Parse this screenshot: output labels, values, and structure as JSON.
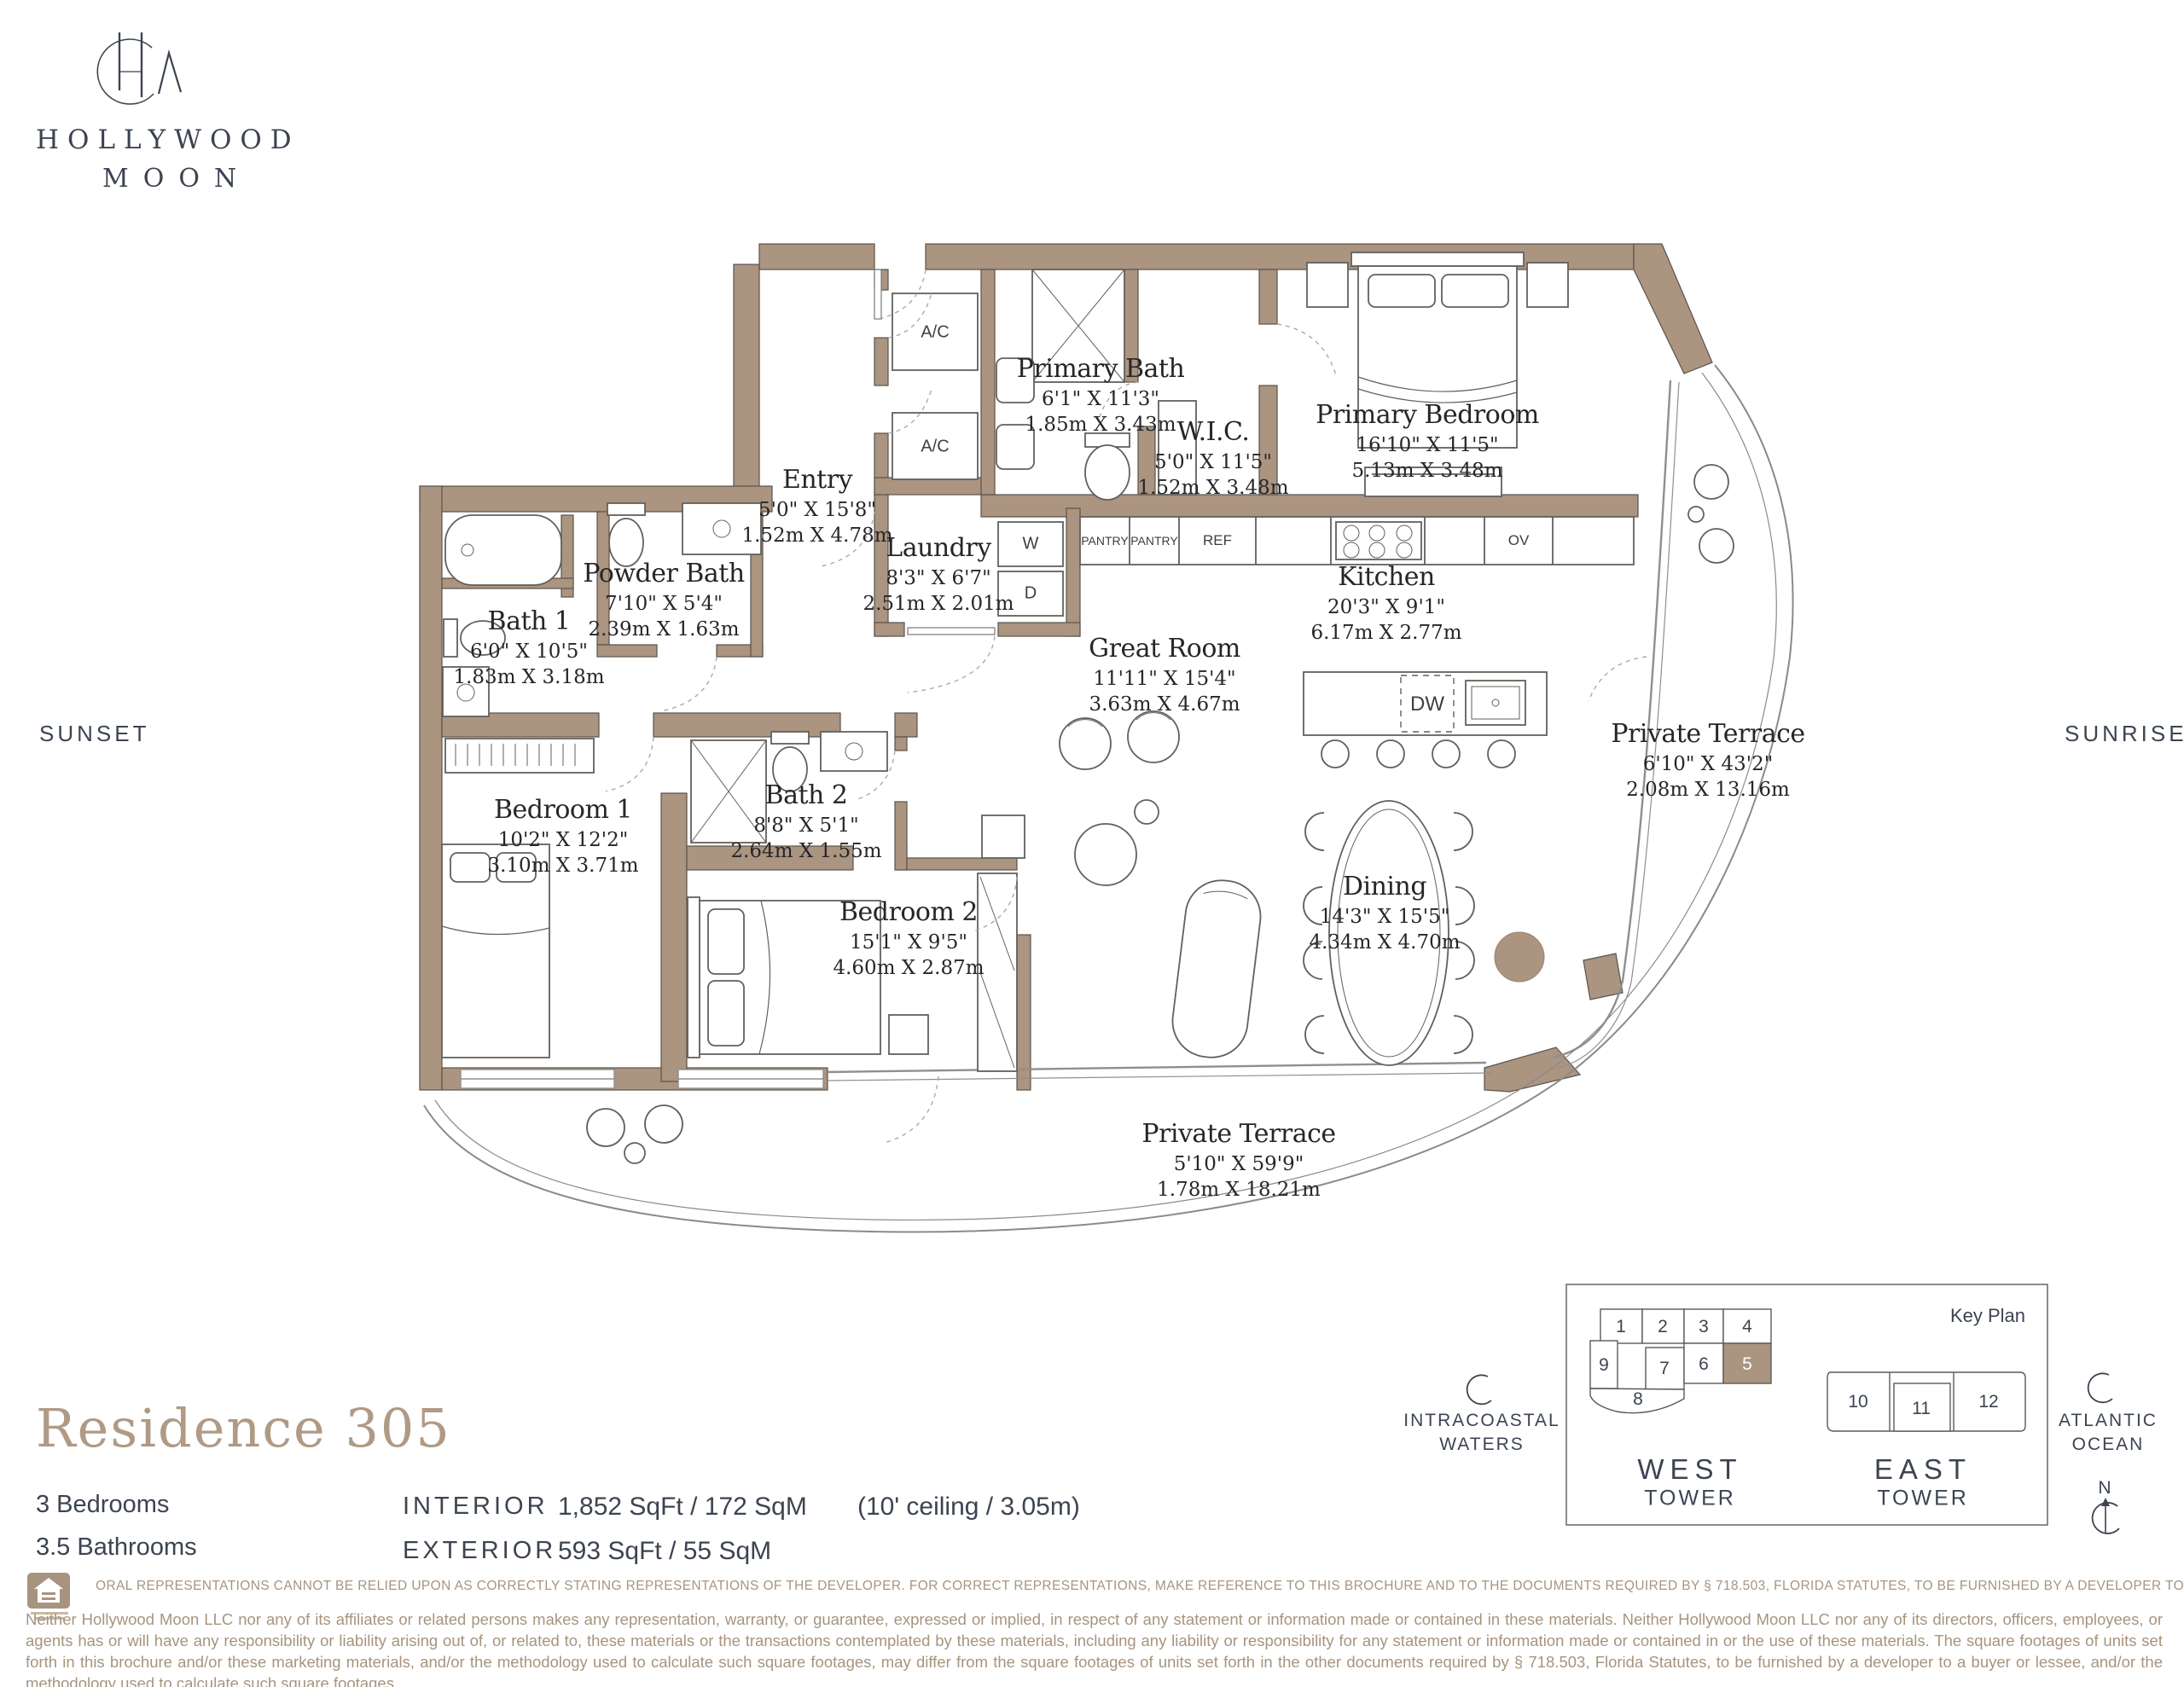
{
  "brand": {
    "line1": "HOLLYWOOD",
    "line2": "MOON"
  },
  "orientation": {
    "left": "SUNSET",
    "right": "SUNRISE"
  },
  "rooms": [
    {
      "name": "Primary Bath",
      "ft": "6'1\" X 11'3\"",
      "m": "1.85m X 3.43m"
    },
    {
      "name": "W.I.C.",
      "ft": "5'0\" X 11'5\"",
      "m": "1.52m X 3.48m"
    },
    {
      "name": "Primary Bedroom",
      "ft": "16'10\" X 11'5\"",
      "m": "5.13m X 3.48m"
    },
    {
      "name": "Entry",
      "ft": "5'0\" X 15'8\"",
      "m": "1.52m X 4.78m"
    },
    {
      "name": "Laundry",
      "ft": "8'3\" X 6'7\"",
      "m": "2.51m X 2.01m"
    },
    {
      "name": "Powder Bath",
      "ft": "7'10\" X 5'4\"",
      "m": "2.39m X 1.63m"
    },
    {
      "name": "Bath 1",
      "ft": "6'0\" X 10'5\"",
      "m": "1.83m X 3.18m"
    },
    {
      "name": "Kitchen",
      "ft": "20'3\" X 9'1\"",
      "m": "6.17m X 2.77m"
    },
    {
      "name": "Great Room",
      "ft": "11'11\" X 15'4\"",
      "m": "3.63m X 4.67m"
    },
    {
      "name": "Private Terrace",
      "ft": "6'10\" X 43'2\"",
      "m": "2.08m X 13.16m"
    },
    {
      "name": "Bedroom 1",
      "ft": "10'2\" X 12'2\"",
      "m": "3.10m X 3.71m"
    },
    {
      "name": "Bath 2",
      "ft": "8'8\" X 5'1\"",
      "m": "2.64m X 1.55m"
    },
    {
      "name": "Bedroom 2",
      "ft": "15'1\" X 9'5\"",
      "m": "4.60m X 2.87m"
    },
    {
      "name": "Dining",
      "ft": "14'3\" X 15'5\"",
      "m": "4.34m X 4.70m"
    },
    {
      "name": "Private Terrace",
      "ft": "5'10\" X 59'9\"",
      "m": "1.78m X 18.21m"
    }
  ],
  "fixtures": {
    "ac1": "A/C",
    "ac2": "A/C",
    "washer": "W",
    "dryer": "D",
    "pantry1": "PANTRY",
    "pantry2": "PANTRY",
    "fridge": "REF",
    "oven": "OV",
    "dishwasher": "DW"
  },
  "residence": {
    "title": "Residence 305",
    "bedrooms": "3 Bedrooms",
    "bathrooms": "3.5 Bathrooms",
    "interior_label": "INTERIOR",
    "interior_value": "1,852 SqFt / 172 SqM",
    "ceiling": "(10' ceiling / 3.05m)",
    "exterior_label": "EXTERIOR",
    "exterior_value": "593 SqFt / 55 SqM"
  },
  "keyplan": {
    "title": "Key Plan",
    "west_units": [
      "1",
      "2",
      "3",
      "4",
      "9",
      "7",
      "6",
      "5",
      "8"
    ],
    "east_units": [
      "10",
      "11",
      "12"
    ],
    "west_tower_line1": "WEST",
    "west_tower_line2": "TOWER",
    "east_tower_line1": "EAST",
    "east_tower_line2": "TOWER",
    "intracoastal_line1": "INTRACOASTAL",
    "intracoastal_line2": "WATERS",
    "atlantic_line1": "ATLANTIC",
    "atlantic_line2": "OCEAN",
    "north": "N"
  },
  "disclaimer": {
    "notice": "ORAL REPRESENTATIONS CANNOT BE RELIED UPON AS CORRECTLY STATING REPRESENTATIONS OF THE DEVELOPER. FOR CORRECT REPRESENTATIONS, MAKE REFERENCE TO THIS BROCHURE AND TO THE DOCUMENTS REQUIRED BY § 718.503, FLORIDA STATUTES, TO BE FURNISHED BY A DEVELOPER TO A BUYER OR LESSEE.",
    "body": "Neither Hollywood Moon LLC nor any of its affiliates or related persons makes any representation, warranty, or guarantee, expressed or implied, in respect of any statement or information made or contained in these materials. Neither Hollywood Moon LLC nor any of its directors, officers, employees, or agents has or will have any responsibility or liability arising out of, or related to, these materials or the transactions contemplated by these materials, including any liability or responsibility for any statement or information made or contained in or the use of these materials. The square footages of units set forth in this brochure and/or these marketing materials, and/or the methodology used to calculate such square footages, may differ from the square footages of units set forth in the other documents required by § 718.503, Florida Statutes, to be furnished by a developer to a buyer or lessee, and/or the methodology used to calculate such square footages."
  },
  "colors": {
    "wall": "#ab9480",
    "accent": "#b09a85",
    "ink": "#3c4451",
    "muted": "#a7947e"
  }
}
